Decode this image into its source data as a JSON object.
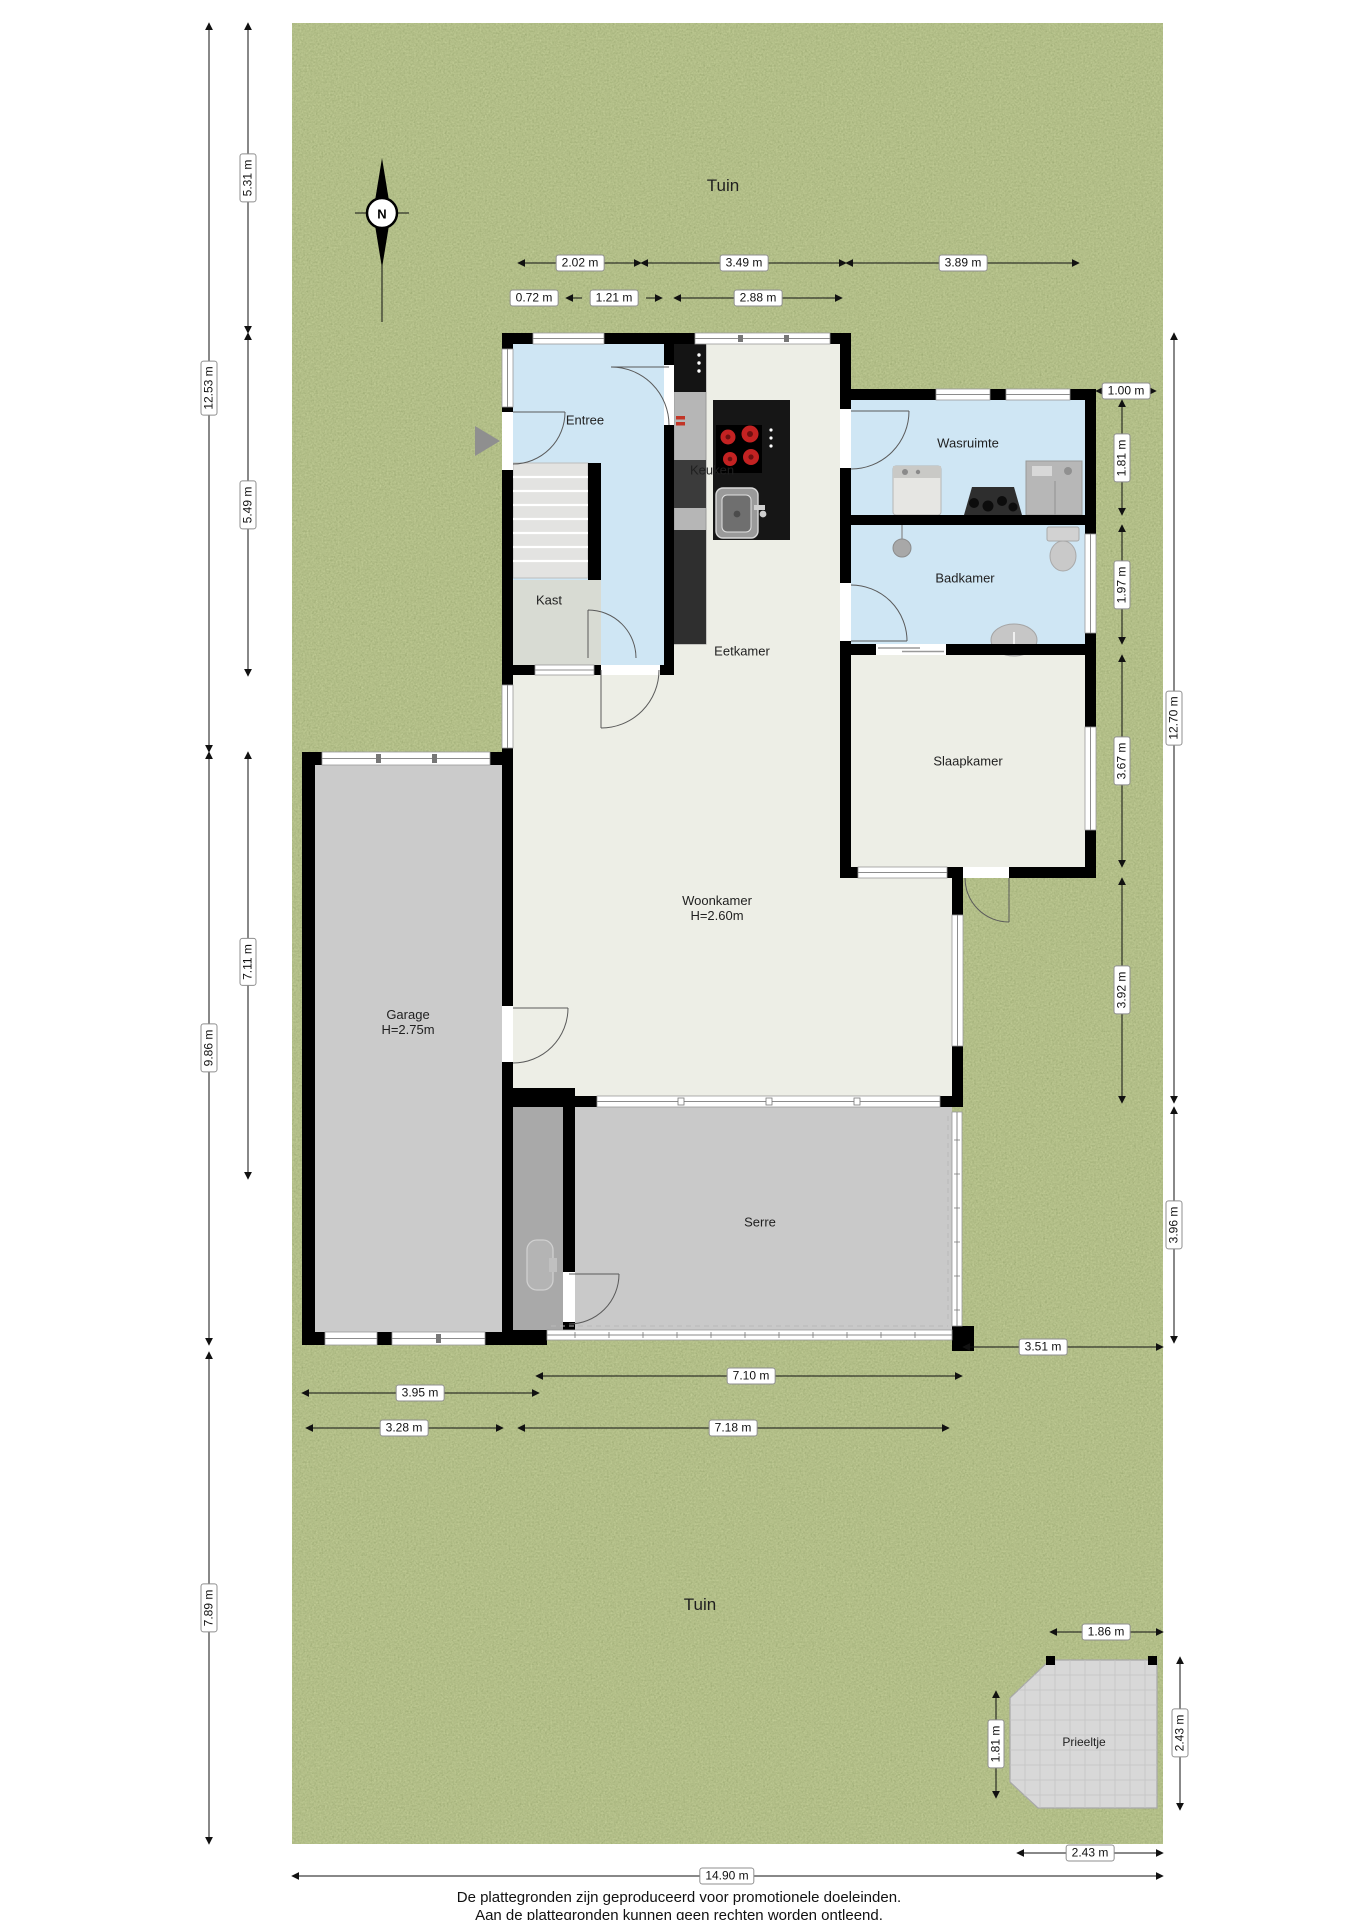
{
  "page": {
    "footer_line1": "De plattegronden zijn geproduceerd voor promotionele doeleinden.",
    "footer_line2": "Aan de plattegronden kunnen geen rechten worden ontleend."
  },
  "compass": {
    "label": "N"
  },
  "garden": {
    "label_top": "Tuin",
    "label_bottom": "Tuin"
  },
  "rooms": {
    "entree": "Entree",
    "kast": "Kast",
    "keuken": "Keuken",
    "eetkamer": "Eetkamer",
    "wasruimte": "Wasruimte",
    "badkamer": "Badkamer",
    "slaapkamer": "Slaapkamer",
    "woonkamer": "Woonkamer",
    "woonkamer_height": "H=2.60m",
    "garage": "Garage",
    "garage_height": "H=2.75m",
    "serre": "Serre",
    "prieeltje": "Prieeltje"
  },
  "dims": {
    "t1": "2.02 m",
    "t2": "3.49 m",
    "t3": "3.89 m",
    "t4": "0.72 m",
    "t5": "1.21 m",
    "t6": "2.88 m",
    "r1": "1.00 m",
    "r2": "1.81 m",
    "r3": "1.97 m",
    "r4": "3.67 m",
    "r5": "3.92 m",
    "r6": "12.70 m",
    "r7": "3.96 m",
    "r8": "3.51 m",
    "l1": "5.31 m",
    "l2": "12.53 m",
    "l3": "5.49 m",
    "l4": "7.11 m",
    "l5": "9.86 m",
    "l6": "7.89 m",
    "b1": "7.10 m",
    "b2": "3.95 m",
    "b3": "3.28 m",
    "b4": "7.18 m",
    "b5": "14.90 m",
    "p1": "1.86 m",
    "p2": "1.81 m",
    "p3": "2.43 m",
    "p4": "2.43 m"
  },
  "icons": {
    "compass": "compass-rose-north",
    "entrance": "entrance-direction-arrow"
  },
  "colors": {
    "grass": "#7a8b44",
    "wall": "#000000",
    "room_cream": "#edeee6",
    "room_blue": "#cfe6f4",
    "garage_gray": "#cbcbcb",
    "serre_gray": "#c9c9c9",
    "burner_red": "#c32222"
  }
}
